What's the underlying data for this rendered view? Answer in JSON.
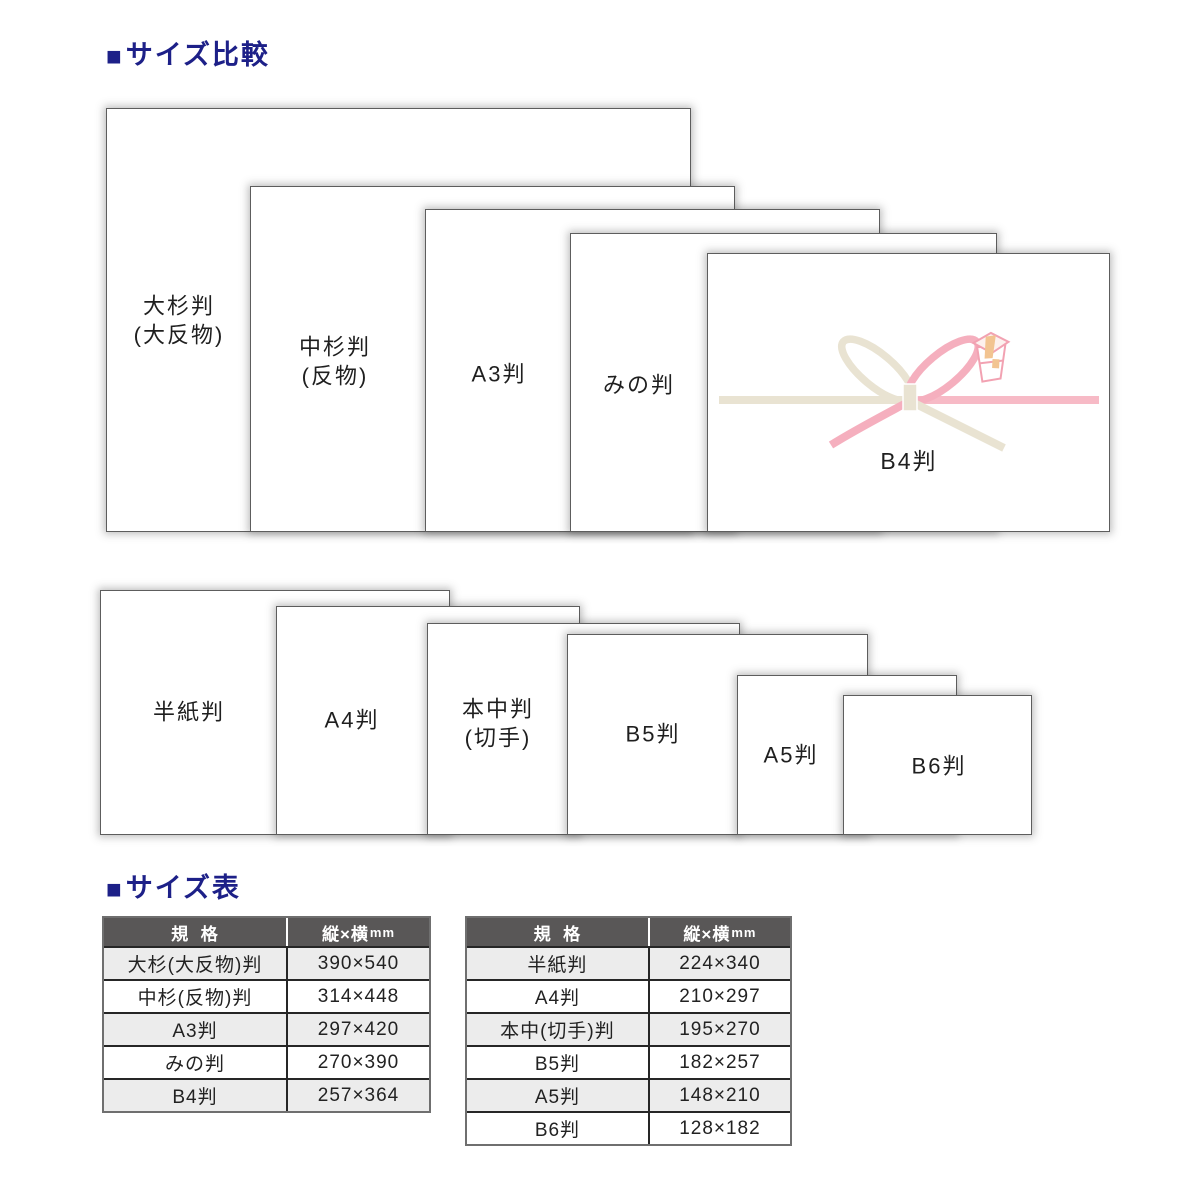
{
  "headings": {
    "bullet": "■",
    "size_comparison": "サイズ比較",
    "size_table": "サイズ表"
  },
  "comparison": {
    "row1": [
      {
        "label": "大杉判\n(大反物)"
      },
      {
        "label": "中杉判\n(反物)"
      },
      {
        "label": "A3判"
      },
      {
        "label": "みの判"
      },
      {
        "label": "B4判"
      }
    ],
    "row2": [
      {
        "label": "半紙判"
      },
      {
        "label": "A4判"
      },
      {
        "label": "本中判\n(切手)"
      },
      {
        "label": "B5判"
      },
      {
        "label": "A5判"
      },
      {
        "label": "B6判"
      }
    ]
  },
  "tables": {
    "header": {
      "col1": "規  格",
      "col2": "縦×横",
      "col2_unit": "mm"
    },
    "left": {
      "rows": [
        {
          "name": "大杉(大反物)判",
          "size": "390×540"
        },
        {
          "name": "中杉(反物)判",
          "size": "314×448"
        },
        {
          "name": "A3判",
          "size": "297×420"
        },
        {
          "name": "みの判",
          "size": "270×390"
        },
        {
          "name": "B4判",
          "size": "257×364"
        }
      ]
    },
    "right": {
      "rows": [
        {
          "name": "半紙判",
          "size": "224×340"
        },
        {
          "name": "A4判",
          "size": "210×297"
        },
        {
          "name": "本中(切手)判",
          "size": "195×270"
        },
        {
          "name": "B5判",
          "size": "182×257"
        },
        {
          "name": "A5判",
          "size": "148×210"
        },
        {
          "name": "B6判",
          "size": "128×182"
        }
      ]
    }
  },
  "colors": {
    "heading_blue": "#1d2088",
    "table_header_bg": "#595757",
    "table_row_alt_bg": "#ececec",
    "ribbon_cream": "#e9e3d2",
    "ribbon_pink": "#f5afbe",
    "noshi_tan": "#f2c491"
  }
}
